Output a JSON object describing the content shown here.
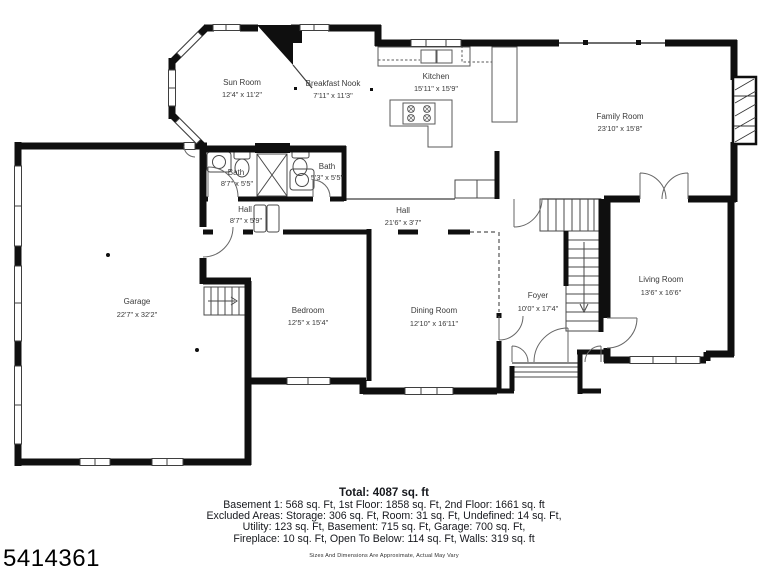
{
  "plan": {
    "rooms": [
      {
        "name": "Sun Room",
        "dims": "12'4\" x 11'2\""
      },
      {
        "name": "Breakfast Nook",
        "dims": "7'11\" x 11'3\""
      },
      {
        "name": "Kitchen",
        "dims": "15'11\" x 15'9\""
      },
      {
        "name": "Family Room",
        "dims": "23'10\" x 15'8\""
      },
      {
        "name": "Bath",
        "dims": "8'7\" x 5'5\""
      },
      {
        "name": "Bath",
        "dims": "5'3\" x 5'5\""
      },
      {
        "name": "Hall",
        "dims": "8'7\" x 5'9\""
      },
      {
        "name": "Hall",
        "dims": "21'6\" x 3'7\""
      },
      {
        "name": "Garage",
        "dims": "22'7\" x 32'2\""
      },
      {
        "name": "Bedroom",
        "dims": "12'5\" x 15'4\""
      },
      {
        "name": "Dining Room",
        "dims": "12'10\" x 16'11\""
      },
      {
        "name": "Foyer",
        "dims": "10'0\" x 17'4\""
      },
      {
        "name": "Living Room",
        "dims": "13'6\" x 16'6\""
      }
    ],
    "colors": {
      "wall": "#0f0f0f",
      "fixture_line": "#4a4a4a",
      "label": "#3a3a3a"
    }
  },
  "footer": {
    "total": "Total: 4087 sq. ft",
    "lines": [
      "Basement 1: 568 sq. Ft, 1st Floor: 1858 sq. Ft, 2nd Floor: 1661 sq. ft",
      "Excluded Areas: Storage: 306 sq. Ft, Room: 31 sq. Ft, Undefined: 14 sq. Ft,",
      "Utility: 123 sq. Ft, Basement: 715 sq. Ft, Garage: 700 sq. Ft,",
      "Fireplace: 10 sq. Ft, Open To Below: 114 sq. Ft, Walls: 319 sq. ft"
    ],
    "disclaimer": "Sizes And Dimensions Are Approximate, Actual May Vary"
  },
  "photo_id": "5414361"
}
